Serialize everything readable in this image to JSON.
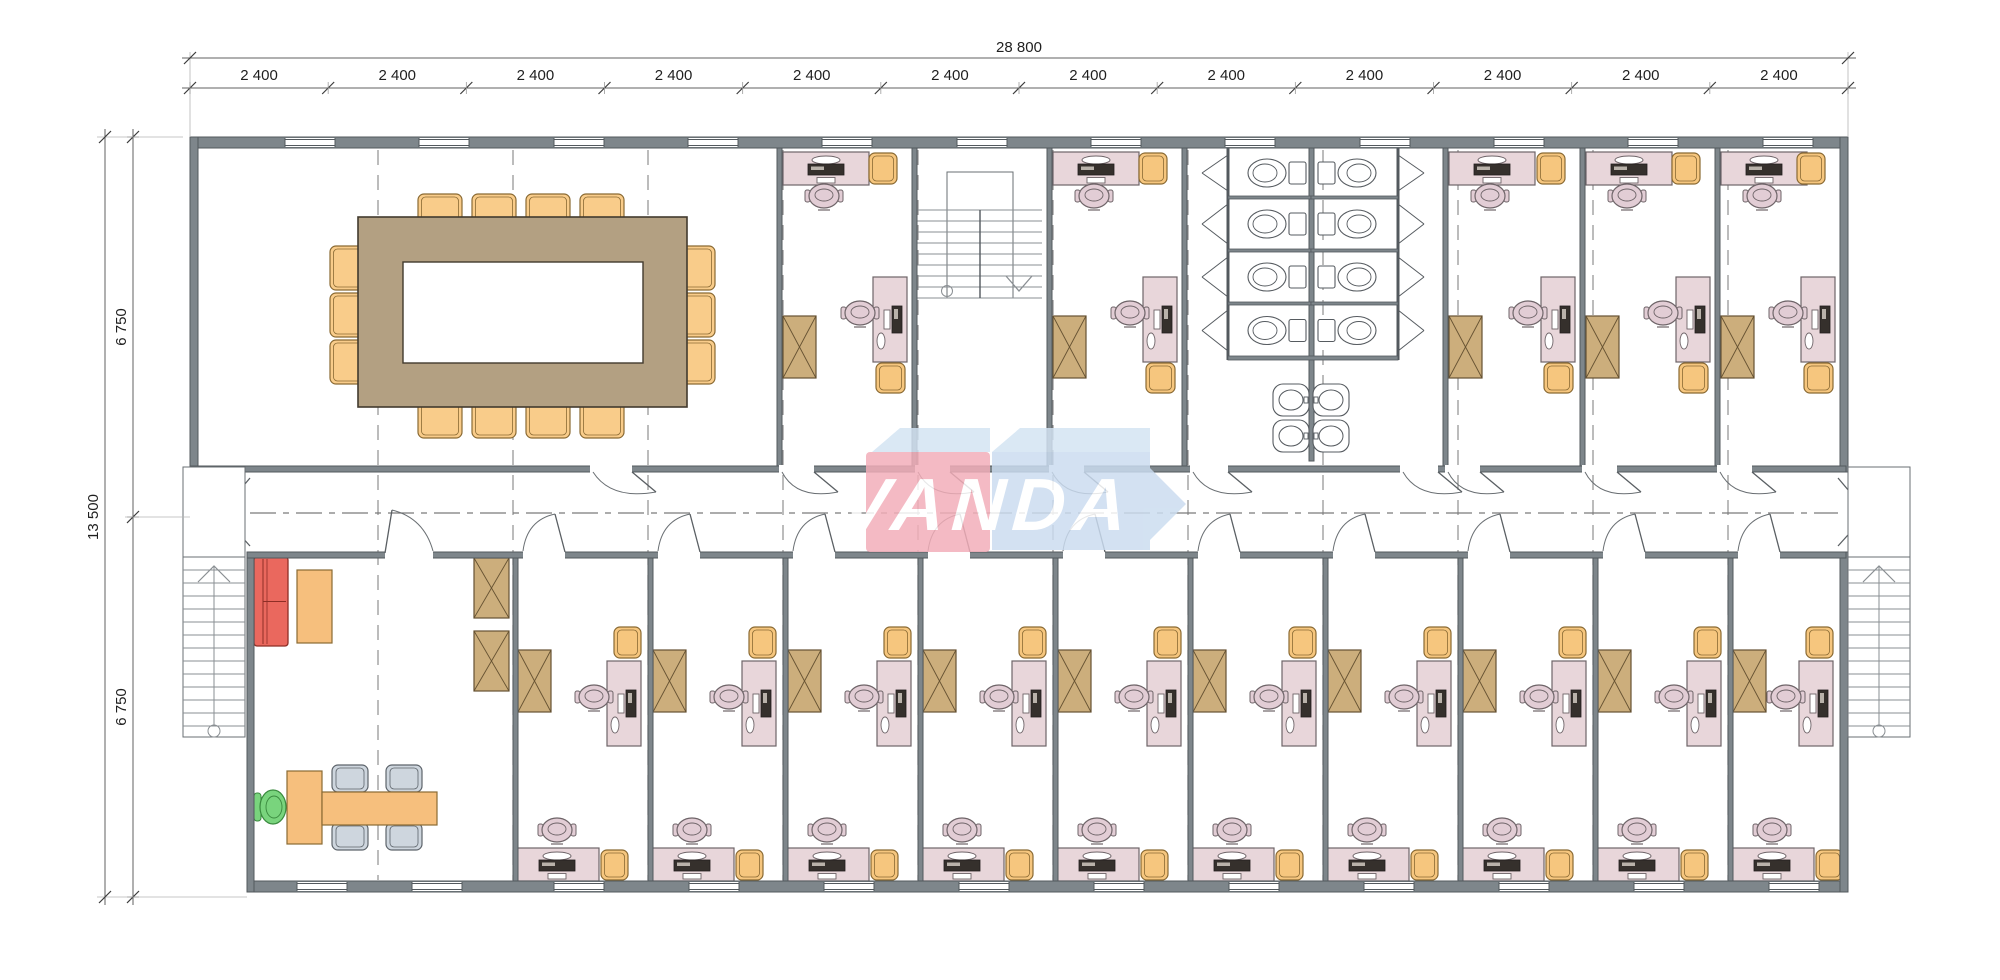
{
  "title": "Office floor plan",
  "dims": {
    "top_total": "28 800",
    "seg_label": "2 400",
    "seg_count": 12,
    "left_total": "13 500",
    "left_upper": "6 750",
    "left_lower": "6 750"
  },
  "logo": {
    "text": "VANDA"
  },
  "colors": {
    "wall": "#7e868b",
    "wallDark": "#53595e",
    "teal": "#64928f",
    "desk": "#e8d6da",
    "deskLine": "#6e6468",
    "chair": "#e2cdd5",
    "armchair": "#f6c67e",
    "armchairLine": "#8a6a33",
    "confChair": "#f9cc8a",
    "table": "#b3a082",
    "tableLine": "#423a2e",
    "cabinet": "#ccae7c",
    "cabinetLine": "#665232",
    "sofa": "#ea685e",
    "sofaLine": "#8e2e26",
    "orange": "#f6bf7d",
    "grayChair": "#ced6de",
    "grayChairLine": "#5d646b",
    "green": "#79d47d",
    "greenLine": "#3a8a3e",
    "fixture": "#ffffff",
    "fixtureLine": "#565b60",
    "monitor": "#35302c",
    "grid": "#909090",
    "dimLine": "#606060",
    "dimText": "#1f1f1f",
    "thin": "#6a6f73",
    "tread": "#8a8f93",
    "doorLine": "#5a5f63",
    "logoRed": "#f3aeb9",
    "logoBlue": "#cbdcf0",
    "logoTop": "#d3e4f3",
    "logoText": "#ffffff"
  },
  "layout": {
    "bx0": 190,
    "bx1": 1848,
    "topWallY": 137,
    "wallT": 11,
    "corrTopY": 466,
    "corrBotY": 552,
    "botWallY": 881,
    "leftBotX": 247,
    "roomsTopY0": 148,
    "roomsTopY1": 466,
    "roomsBotY0": 558,
    "roomsBotY1": 881,
    "innerTopWalls": [
      777,
      912,
      1047,
      1182,
      1443,
      1580,
      1715
    ],
    "innerBotWalls": [
      513,
      648,
      783,
      918,
      1053,
      1188,
      1323,
      1458,
      1593,
      1728
    ],
    "grid": [
      378,
      513,
      648,
      783,
      918,
      1053,
      1188,
      1323,
      1458,
      1593,
      1728
    ],
    "corrCenterY": 513,
    "windowsTop": [
      285,
      419,
      554,
      688,
      822,
      957,
      1091,
      1225,
      1360,
      1494,
      1628,
      1763
    ],
    "windowsBottom": [
      297,
      412,
      554,
      689,
      824,
      959,
      1094,
      1229,
      1364,
      1499,
      1634,
      1769
    ],
    "winW": 50,
    "gapsTop": [
      [
        590,
        632
      ],
      [
        779,
        814
      ],
      [
        915,
        950
      ],
      [
        1049,
        1084
      ],
      [
        1190,
        1228
      ],
      [
        1400,
        1438
      ],
      [
        1445,
        1480
      ],
      [
        1582,
        1617
      ],
      [
        1717,
        1752
      ]
    ],
    "gapsBottom": [
      [
        385,
        433
      ],
      [
        523,
        565
      ],
      [
        658,
        700
      ],
      [
        793,
        835
      ],
      [
        928,
        970
      ],
      [
        1063,
        1105
      ],
      [
        1198,
        1240
      ],
      [
        1333,
        1375
      ],
      [
        1468,
        1510
      ],
      [
        1603,
        1645
      ],
      [
        1738,
        1780
      ]
    ],
    "topOffices": [
      [
        777,
        912
      ],
      [
        1047,
        1182
      ],
      [
        1443,
        1580
      ],
      [
        1580,
        1715
      ],
      [
        1715,
        1840
      ]
    ],
    "bottomOffices": [
      [
        513,
        648
      ],
      [
        648,
        783
      ],
      [
        783,
        918
      ],
      [
        918,
        1053
      ],
      [
        1053,
        1188
      ],
      [
        1188,
        1323
      ],
      [
        1323,
        1458
      ],
      [
        1458,
        1593
      ],
      [
        1593,
        1728
      ],
      [
        1728,
        1840
      ]
    ],
    "meeting": {
      "table": [
        358,
        217,
        329,
        190
      ],
      "hole": [
        403,
        262,
        240,
        101
      ],
      "topChairX": [
        418,
        472,
        526,
        580
      ],
      "sideChairY": [
        246,
        293,
        340
      ],
      "leftChairX": 330,
      "rightChairX": 677
    },
    "stairwell": {
      "inner": [
        947,
        172,
        66,
        126
      ],
      "x0": 917,
      "x1": 1042,
      "treadY0": 210,
      "treadY1": 298,
      "treadStep": 11,
      "midX": 980
    },
    "toilets": {
      "x0": 1182,
      "x1": 1443,
      "thinL": 1228,
      "thinR": 1398,
      "midX": 1311,
      "divY": [
        196,
        249,
        302
      ],
      "stallBotY": 356,
      "rows": [
        [
          150,
          196
        ],
        [
          199,
          249
        ],
        [
          252,
          302
        ],
        [
          305,
          356
        ]
      ],
      "sinkY": [
        384,
        420
      ]
    },
    "reception": {
      "sofa": [
        254,
        557,
        34,
        89
      ],
      "coffee": [
        297,
        570,
        35,
        73
      ],
      "deskV": [
        287,
        771,
        35,
        73
      ],
      "deskH": [
        322,
        792,
        115,
        33
      ],
      "green": [
        258,
        789,
        30,
        36
      ],
      "grayChairs": [
        [
          332,
          765
        ],
        [
          386,
          765
        ],
        [
          332,
          823
        ],
        [
          386,
          823
        ]
      ],
      "cabinets": [
        [
          474,
          558
        ],
        [
          474,
          631
        ]
      ],
      "tealWall": [
        252,
        552,
        106,
        6
      ]
    },
    "extStairs": {
      "left": {
        "landing": [
          183,
          467,
          62,
          90
        ],
        "stair": [
          183,
          557,
          62,
          180
        ]
      },
      "right": {
        "landing": [
          1848,
          467,
          62,
          90
        ],
        "stair": [
          1848,
          557,
          62,
          180
        ]
      }
    },
    "logo": {
      "redBox": [
        866,
        452,
        124,
        100
      ],
      "redTop": [
        [
          872,
          452
        ],
        [
          900,
          428
        ],
        [
          990,
          428
        ],
        [
          990,
          452
        ]
      ],
      "blueTop": [
        [
          992,
          452
        ],
        [
          1020,
          428
        ],
        [
          1150,
          428
        ],
        [
          1150,
          452
        ]
      ],
      "bluePoly": [
        [
          992,
          452
        ],
        [
          1150,
          452
        ],
        [
          1150,
          468
        ],
        [
          1186,
          504
        ],
        [
          1150,
          540
        ],
        [
          1150,
          550
        ],
        [
          992,
          550
        ]
      ],
      "textX": 876,
      "textY": 530
    },
    "dimsPos": {
      "topLineY": 58,
      "segLineY": 88,
      "leftOuterX": 105,
      "leftInnerX": 133,
      "y0": 137,
      "y1": 897,
      "splitY": 517
    }
  }
}
